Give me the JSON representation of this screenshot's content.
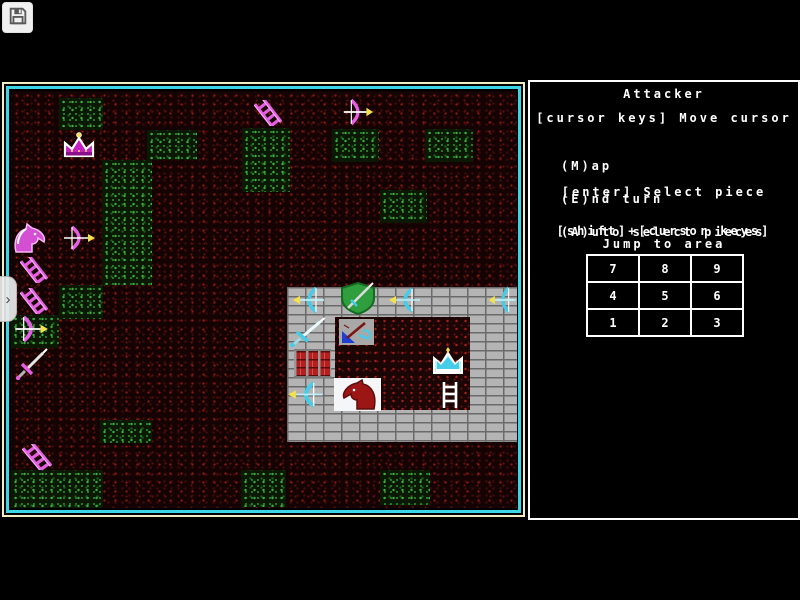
{
  "toolbar": {
    "save_icon": "floppy-disk"
  },
  "side_tab": {
    "icon": "chevron-right",
    "glyph": "›"
  },
  "panel": {
    "title": "Attacker",
    "cursor_line": "[cursor keys] Move cursor",
    "menu": [
      "(M)ap",
      "(E)nd turn",
      "(A)uto select pieces"
    ],
    "enter_line": "[enter] Select piece",
    "shift_line": "[shift]+[cursor keys]",
    "jump_line": "Jump to area",
    "numpad": [
      "7",
      "8",
      "9",
      "4",
      "5",
      "6",
      "1",
      "2",
      "3"
    ]
  },
  "colors": {
    "map_border_outer": "#f2eec2",
    "map_border_inner": "#3bd5e6",
    "panel_border": "#ffffff",
    "attacker_pink": "#e45fe4",
    "defender_cyan": "#45cce8",
    "accent_yellow": "#f4e24a",
    "terrain_red": "#8a1a12",
    "terrain_green": "#3cae3c",
    "brick_gray": "#b4b4b4"
  },
  "game": {
    "castle": {
      "x": 276,
      "y": 196,
      "w": 232,
      "h": 155,
      "courtyard": {
        "x": 48,
        "y": 30,
        "w": 135,
        "h": 93
      }
    },
    "green_patches": [
      {
        "x": 48,
        "y": 7,
        "w": 44,
        "h": 32
      },
      {
        "x": 136,
        "y": 39,
        "w": 50,
        "h": 30
      },
      {
        "x": 231,
        "y": 37,
        "w": 48,
        "h": 64
      },
      {
        "x": 321,
        "y": 38,
        "w": 47,
        "h": 33
      },
      {
        "x": 414,
        "y": 38,
        "w": 48,
        "h": 33
      },
      {
        "x": 369,
        "y": 99,
        "w": 47,
        "h": 33
      },
      {
        "x": 91,
        "y": 69,
        "w": 50,
        "h": 125
      },
      {
        "x": 48,
        "y": 194,
        "w": 44,
        "h": 34
      },
      {
        "x": 0,
        "y": 224,
        "w": 48,
        "h": 33
      },
      {
        "x": 89,
        "y": 329,
        "w": 52,
        "h": 23
      },
      {
        "x": 0,
        "y": 379,
        "w": 92,
        "h": 38
      },
      {
        "x": 230,
        "y": 379,
        "w": 45,
        "h": 37
      },
      {
        "x": 369,
        "y": 379,
        "w": 50,
        "h": 35
      }
    ],
    "pieces": [
      {
        "name": "attacker-crown",
        "type": "pink-crown",
        "x": 49,
        "y": 41,
        "w": 38,
        "h": 28
      },
      {
        "name": "attacker-ladder-1",
        "type": "pink-ladder",
        "x": 243,
        "y": 9,
        "w": 28,
        "h": 26
      },
      {
        "name": "attacker-bow-1",
        "type": "pink-bow-right",
        "x": 329,
        "y": 7,
        "w": 34,
        "h": 28
      },
      {
        "name": "attacker-horse",
        "type": "pink-horse",
        "x": 0,
        "y": 131,
        "w": 40,
        "h": 32
      },
      {
        "name": "attacker-bow-2",
        "type": "pink-bow-right",
        "x": 49,
        "y": 134,
        "w": 36,
        "h": 26
      },
      {
        "name": "attacker-ladder-2",
        "type": "pink-ladder",
        "x": 9,
        "y": 166,
        "w": 28,
        "h": 26
      },
      {
        "name": "attacker-ladder-3",
        "type": "pink-ladder",
        "x": 9,
        "y": 197,
        "w": 28,
        "h": 26
      },
      {
        "name": "attacker-bow-4",
        "type": "pink-bow-right",
        "x": 0,
        "y": 224,
        "w": 38,
        "h": 28
      },
      {
        "name": "attacker-sword",
        "type": "pink-sword",
        "x": 3,
        "y": 257,
        "w": 36,
        "h": 32
      },
      {
        "name": "attacker-ladder-5",
        "type": "pink-ladder",
        "x": 11,
        "y": 353,
        "w": 30,
        "h": 26
      },
      {
        "name": "defender-bow-1",
        "type": "cyan-bow-left",
        "x": 281,
        "y": 195,
        "w": 36,
        "h": 28
      },
      {
        "name": "defender-shield",
        "type": "green-shield",
        "x": 328,
        "y": 191,
        "w": 38,
        "h": 33
      },
      {
        "name": "defender-bow-2",
        "type": "cyan-bow-left",
        "x": 377,
        "y": 196,
        "w": 36,
        "h": 26
      },
      {
        "name": "defender-bow-3",
        "type": "cyan-bow-left",
        "x": 477,
        "y": 195,
        "w": 31,
        "h": 28
      },
      {
        "name": "defender-sword",
        "type": "cyan-sword",
        "x": 277,
        "y": 226,
        "w": 40,
        "h": 30
      },
      {
        "name": "selected-piece-tile",
        "type": "sel-tile",
        "x": 328,
        "y": 228,
        "w": 35,
        "h": 26
      },
      {
        "name": "castle-gate",
        "type": "gate",
        "x": 283,
        "y": 258,
        "w": 37,
        "h": 29
      },
      {
        "name": "defender-crown",
        "type": "cyan-crown",
        "x": 419,
        "y": 255,
        "w": 36,
        "h": 32
      },
      {
        "name": "defender-bow-4",
        "type": "cyan-bow-left",
        "x": 276,
        "y": 290,
        "w": 40,
        "h": 27
      },
      {
        "name": "defender-horse-tile",
        "type": "red-horse-tile",
        "x": 323,
        "y": 287,
        "w": 47,
        "h": 33
      },
      {
        "name": "defender-ladder",
        "type": "white-ladder",
        "x": 428,
        "y": 290,
        "w": 22,
        "h": 28
      }
    ]
  }
}
